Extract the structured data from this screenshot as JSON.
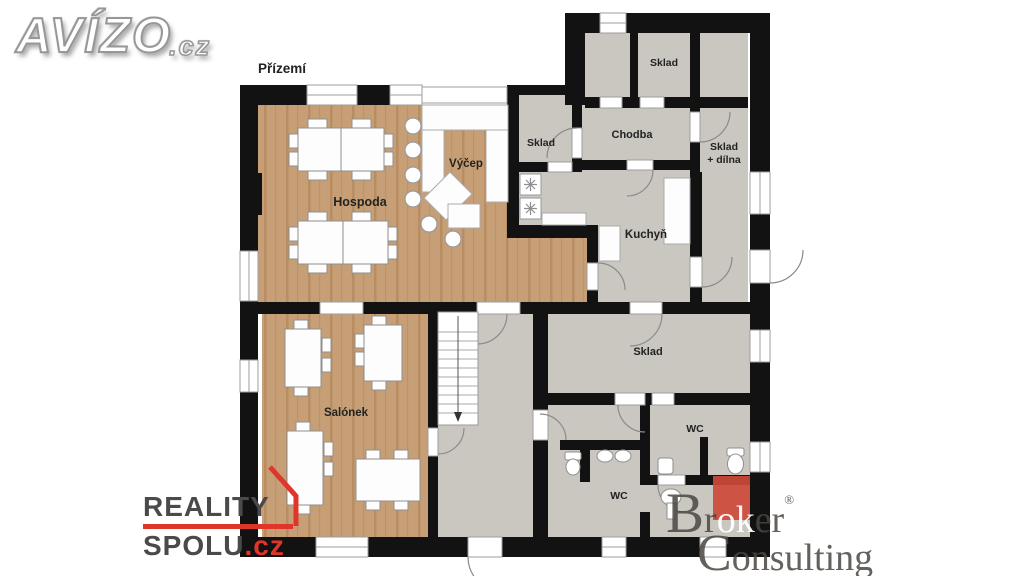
{
  "page": {
    "floor_label": "Přízemí",
    "background": "#ffffff"
  },
  "branding": {
    "avizo": {
      "name": "AVÍZO",
      "tld": ".cz"
    },
    "reality_spolu": {
      "line1": "REALITY",
      "line2": "SPOLU",
      "tld": ".cz",
      "accent_color": "#e0352b",
      "text_color": "#4a4a4a"
    },
    "broker_consulting": {
      "b1": "Br",
      "b2": "ok",
      "b3": "er",
      "reg": "®",
      "line2": "Consulting",
      "square_color": "#cd4a3a",
      "text_color": "#4a4642"
    }
  },
  "plan": {
    "rooms": {
      "hospoda": "Hospoda",
      "vycep": "Výčep",
      "sklad_small": "Sklad",
      "chodba": "Chodba",
      "sklad_annex": "Sklad",
      "sklad_dilna_l1": "Sklad",
      "sklad_dilna_l2": "+ dílna",
      "kuchyn": "Kuchyň",
      "sklad_big": "Sklad",
      "salonek": "Salónek",
      "wc_right": "WC",
      "wc_bottom": "WC"
    },
    "colors": {
      "wall": "#121212",
      "wood_floor": "#c79f76",
      "wood_line": "#b78d61",
      "gray_floor": "#c9c7c0",
      "fixture_stroke": "#8f8f8f"
    }
  }
}
